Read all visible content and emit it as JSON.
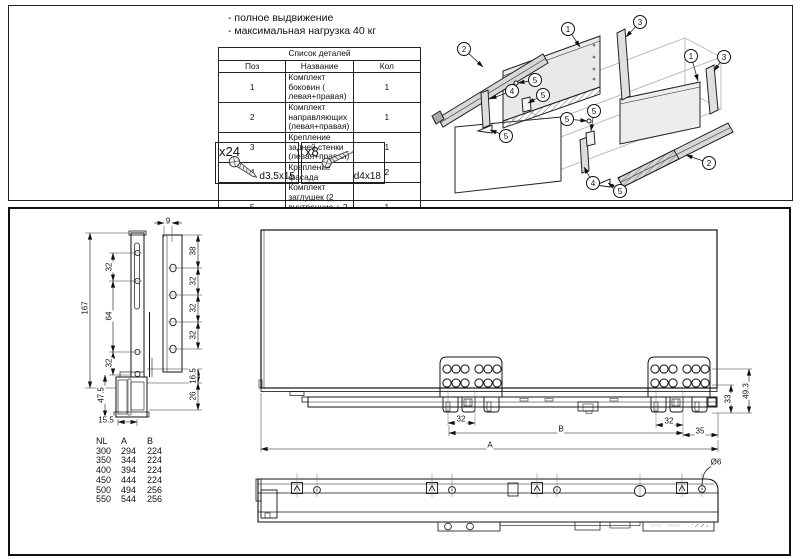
{
  "top": {
    "notes": {
      "line1": "- полное выдвижение",
      "line2": "- максимальная нагрузка 40 кг"
    },
    "parts_table": {
      "title": "Список деталей",
      "columns": [
        "Поз",
        "Название",
        "Кол"
      ],
      "rows": [
        [
          "1",
          "Комплект боковин ( левая+правая)",
          "1"
        ],
        [
          "2",
          "Комплект направляющих (левая+правая)",
          "1"
        ],
        [
          "3",
          "Крепление задней стенки (левая+правая)",
          "1"
        ],
        [
          "4",
          "Крепление фасада",
          "2"
        ],
        [
          "5",
          "Комплект заглушек (2 внутренние + 2 внешние +4 круглые)",
          "1"
        ]
      ]
    },
    "screws": [
      {
        "qty": "x24",
        "size": "d3,5x15"
      },
      {
        "qty": "x8",
        "size": "d4x18"
      }
    ],
    "callouts": [
      {
        "n": "2",
        "x": 36,
        "y": 42,
        "tx": 55,
        "ty": 60
      },
      {
        "n": "1",
        "x": 140,
        "y": 22,
        "tx": 152,
        "ty": 40
      },
      {
        "n": "3",
        "x": 212,
        "y": 15,
        "tx": 198,
        "ty": 30
      },
      {
        "n": "1",
        "x": 263,
        "y": 49,
        "tx": 270,
        "ty": 74
      },
      {
        "n": "3",
        "x": 296,
        "y": 50,
        "tx": 286,
        "ty": 64
      },
      {
        "n": "5",
        "x": 107,
        "y": 73,
        "tx": 90,
        "ty": 76
      },
      {
        "n": "4",
        "x": 84,
        "y": 84,
        "tx": 62,
        "ty": 92
      },
      {
        "n": "5",
        "x": 115,
        "y": 88,
        "tx": 100,
        "ty": 96
      },
      {
        "n": "5",
        "x": 78,
        "y": 129,
        "tx": 62,
        "ty": 123
      },
      {
        "n": "5",
        "x": 139,
        "y": 112,
        "tx": 159,
        "ty": 114
      },
      {
        "n": "5",
        "x": 166,
        "y": 104,
        "tx": 163,
        "ty": 124
      },
      {
        "n": "4",
        "x": 165,
        "y": 176,
        "tx": 156,
        "ty": 160
      },
      {
        "n": "5",
        "x": 192,
        "y": 184,
        "tx": 180,
        "ty": 176
      },
      {
        "n": "2",
        "x": 281,
        "y": 156,
        "tx": 258,
        "ty": 148
      }
    ]
  },
  "bottom": {
    "size_table": {
      "columns": [
        "NL",
        "A",
        "B"
      ],
      "rows": [
        [
          "300",
          "294",
          "224"
        ],
        [
          "350",
          "344",
          "224"
        ],
        [
          "400",
          "394",
          "224"
        ],
        [
          "450",
          "444",
          "224"
        ],
        [
          "500",
          "494",
          "256"
        ],
        [
          "550",
          "544",
          "256"
        ]
      ]
    },
    "dim_labels": [
      {
        "t": "9",
        "x": 168,
        "y": 221,
        "r": 0
      },
      {
        "t": "167",
        "x": 85,
        "y": 308,
        "r": 1
      },
      {
        "t": "32",
        "x": 109,
        "y": 267,
        "r": 1
      },
      {
        "t": "64",
        "x": 109,
        "y": 316,
        "r": 1
      },
      {
        "t": "32",
        "x": 109,
        "y": 363,
        "r": 1
      },
      {
        "t": "47.5",
        "x": 101,
        "y": 395,
        "r": 1
      },
      {
        "t": "38",
        "x": 193,
        "y": 251,
        "r": 1
      },
      {
        "t": "32",
        "x": 193,
        "y": 281,
        "r": 1
      },
      {
        "t": "32",
        "x": 193,
        "y": 308,
        "r": 1
      },
      {
        "t": "32",
        "x": 193,
        "y": 335,
        "r": 1
      },
      {
        "t": "16.5",
        "x": 193,
        "y": 376,
        "r": 1
      },
      {
        "t": "26",
        "x": 193,
        "y": 396,
        "r": 1
      },
      {
        "t": "15.5",
        "x": 106,
        "y": 420,
        "r": 0
      },
      {
        "t": "32",
        "x": 461,
        "y": 419,
        "r": 0
      },
      {
        "t": "B",
        "x": 561,
        "y": 429,
        "r": 0
      },
      {
        "t": "32",
        "x": 669,
        "y": 421,
        "r": 0
      },
      {
        "t": "35",
        "x": 700,
        "y": 431,
        "r": 0
      },
      {
        "t": "A",
        "x": 490,
        "y": 445,
        "r": 0
      },
      {
        "t": "33",
        "x": 728,
        "y": 399,
        "r": 1
      },
      {
        "t": "49.3",
        "x": 746,
        "y": 391,
        "r": 1
      },
      {
        "t": "Ø6",
        "x": 716,
        "y": 462,
        "r": 0
      }
    ]
  }
}
